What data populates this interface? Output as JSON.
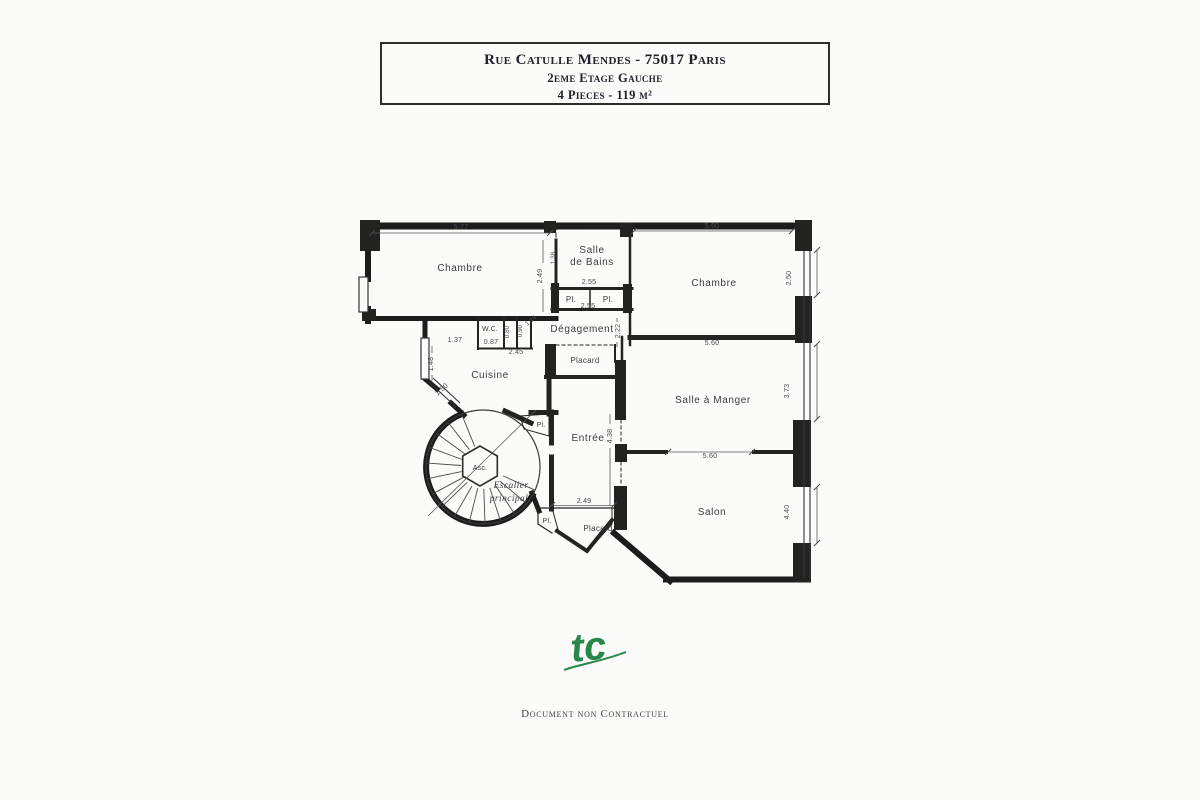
{
  "title_block": {
    "line1": "Rue Catulle Mendes - 75017 Paris",
    "line2": "2eme Etage Gauche",
    "line3": "4 Pieces - 119 m²"
  },
  "plan": {
    "rooms": {
      "chambre_left": "Chambre",
      "salle_de_bains_line1": "Salle",
      "salle_de_bains_line2": "de Bains",
      "pl": "Pl.",
      "chambre_right": "Chambre",
      "degagement": "Dégagement",
      "wc": "W.C.",
      "placard": "Placard",
      "cuisine": "Cuisine",
      "entree": "Entrée",
      "ascenseur": "Asc.",
      "escalier_line1": "Escalier",
      "escalier_line2": "principal",
      "salle_a_manger": "Salle à Manger",
      "salon": "Salon"
    },
    "dimensions": {
      "chambre_left_width": "5.77",
      "chambre_left_depth": "2.49",
      "sdb_wall": "1.38",
      "sdb_width": "2.55",
      "pl_row_width": "2.55",
      "chambre_right_width": "5.60",
      "chambre_right_depth": "2.50",
      "sam_width": "5.60",
      "sam_depth": "3.73",
      "sam_salon_opening": "5.60",
      "salon_depth": "4.40",
      "degagement_depth": "2.22",
      "entree_depth": "4.38",
      "placard_bottom_width": "2.49",
      "vestibule_width": "1.37",
      "wc_width": "0.87",
      "closet_a": "0.80",
      "closet_b": "0.90",
      "entry_diag": "1.14",
      "cuisine_opening": "2.45",
      "cuisine_wall": "1.48",
      "cuisine_diag": "1.50"
    }
  },
  "footer": {
    "logo": "tc",
    "disclaimer": "Document non Contractuel"
  },
  "colors": {
    "wall": "#1c1c1c",
    "paper": "#fbfbf9",
    "logo_green": "#27874a"
  }
}
